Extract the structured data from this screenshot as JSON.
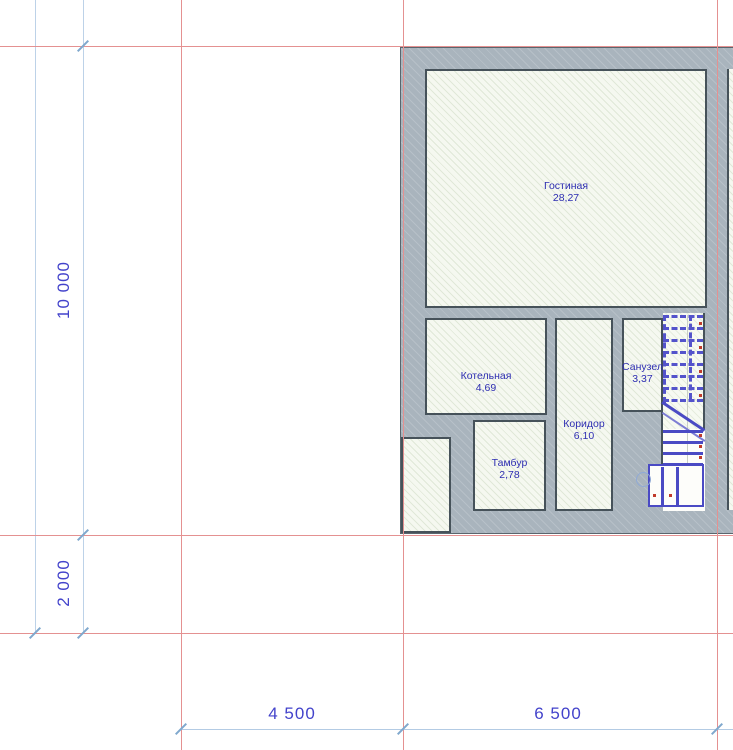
{
  "plan": {
    "rooms": [
      {
        "name": "Гостиная",
        "area": "28,27"
      },
      {
        "name": "Котельная",
        "area": "4,69"
      },
      {
        "name": "Тамбур",
        "area": "2,78"
      },
      {
        "name": "Коридор",
        "area": "6,10"
      },
      {
        "name": "Санузел",
        "area": "3,37"
      }
    ],
    "dimensions": {
      "left_vertical": [
        {
          "value": "10 000"
        },
        {
          "value": "2 000"
        }
      ],
      "bottom_horizontal": [
        {
          "value": "4 500"
        },
        {
          "value": "6 500"
        }
      ]
    },
    "colors": {
      "wall_fill": "#a9b4bd",
      "wall_outline": "#46525a",
      "room_fill": "#f5f8f0",
      "stair_blue": "#4a4ac4",
      "grid_red": "#e49191",
      "dim_line_blue": "#b3cbe4",
      "dim_text_blue": "#4343cb",
      "room_text_blue": "#2e2eb2",
      "step_mark_red": "#c03a2b"
    }
  }
}
